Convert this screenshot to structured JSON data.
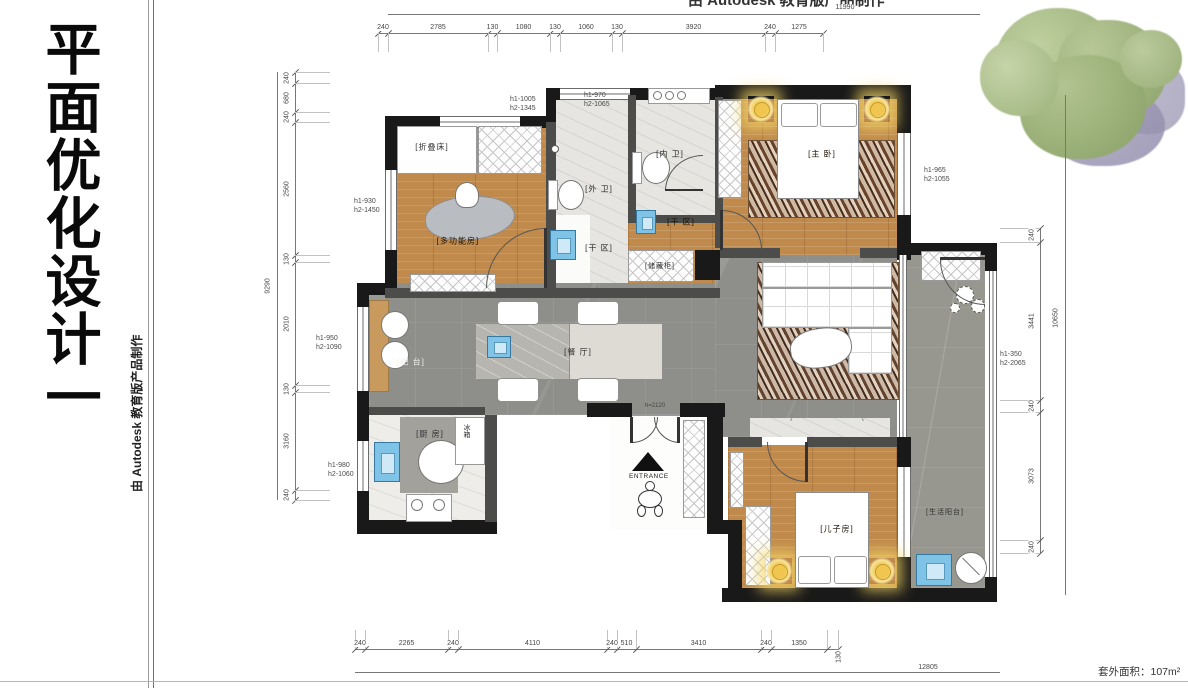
{
  "titles": {
    "main_vertical": "平面优化设计一",
    "credit_side": "由 Autodesk 教育版产品制作",
    "credit_top": "由 Autodesk 教育版产品制作"
  },
  "plan": {
    "room_labels": [
      {
        "id": "folding-bed",
        "text": "[折叠床]"
      },
      {
        "id": "multi-room",
        "text": "[多功能房]"
      },
      {
        "id": "outer-bath",
        "text": "[外 卫]"
      },
      {
        "id": "inner-bath",
        "text": "[内 卫]"
      },
      {
        "id": "dry-area-1",
        "text": "[干 区]"
      },
      {
        "id": "dry-area-2",
        "text": "[干 区]"
      },
      {
        "id": "storage-cabinet",
        "text": "[储藏柜]"
      },
      {
        "id": "master-bedroom",
        "text": "[主 卧]"
      },
      {
        "id": "bar-counter",
        "text": "[吧 台]"
      },
      {
        "id": "dining-room",
        "text": "[餐 厅]"
      },
      {
        "id": "kitchen",
        "text": "[厨 房]"
      },
      {
        "id": "kids-room",
        "text": "[儿子房]"
      },
      {
        "id": "utility-balcony",
        "text": "[生活阳台]"
      }
    ],
    "annotations": {
      "fridge": "冰箱",
      "entrance": "ENTRANCE",
      "door_height": "h=2120"
    },
    "window_labels": [
      {
        "line1": "h1-1005",
        "line2": "h2-1345"
      },
      {
        "line1": "h1-970",
        "line2": "h2-1065"
      },
      {
        "line1": "h1-930",
        "line2": "h2-1450"
      },
      {
        "line1": "h1-950",
        "line2": "h2-1090"
      },
      {
        "line1": "h1-980",
        "line2": "h2-1060"
      },
      {
        "line1": "h1-965",
        "line2": "h2-1055"
      },
      {
        "line1": "h1-350",
        "line2": "h2-2065"
      }
    ]
  },
  "dimensions": {
    "top": {
      "overall": "11990",
      "segments": [
        "240",
        "2785",
        "130",
        "1080",
        "130",
        "1060",
        "130",
        "3920",
        "240",
        "1275"
      ]
    },
    "bottom": {
      "overall": "12805",
      "segments": [
        "240",
        "2265",
        "240",
        "4110",
        "240",
        "510",
        "3410",
        "240",
        "1350",
        "130"
      ]
    },
    "left": {
      "overall": "9290",
      "segments": [
        "240",
        "680",
        "240",
        "2560",
        "130",
        "2010",
        "130",
        "3160",
        "240"
      ]
    },
    "right": {
      "overall": "10650",
      "segments": [
        "240",
        "3441",
        "240",
        "3073",
        "240"
      ]
    }
  },
  "footer": {
    "area_text": "套外面积：107m²"
  },
  "colors": {
    "wall": "#191919",
    "wood_floor": "#bf8a4c",
    "tile_gray": "#8e8e8a",
    "fixture_blue": "#7fc4e6",
    "lamp_yellow": "#f0c64f"
  }
}
